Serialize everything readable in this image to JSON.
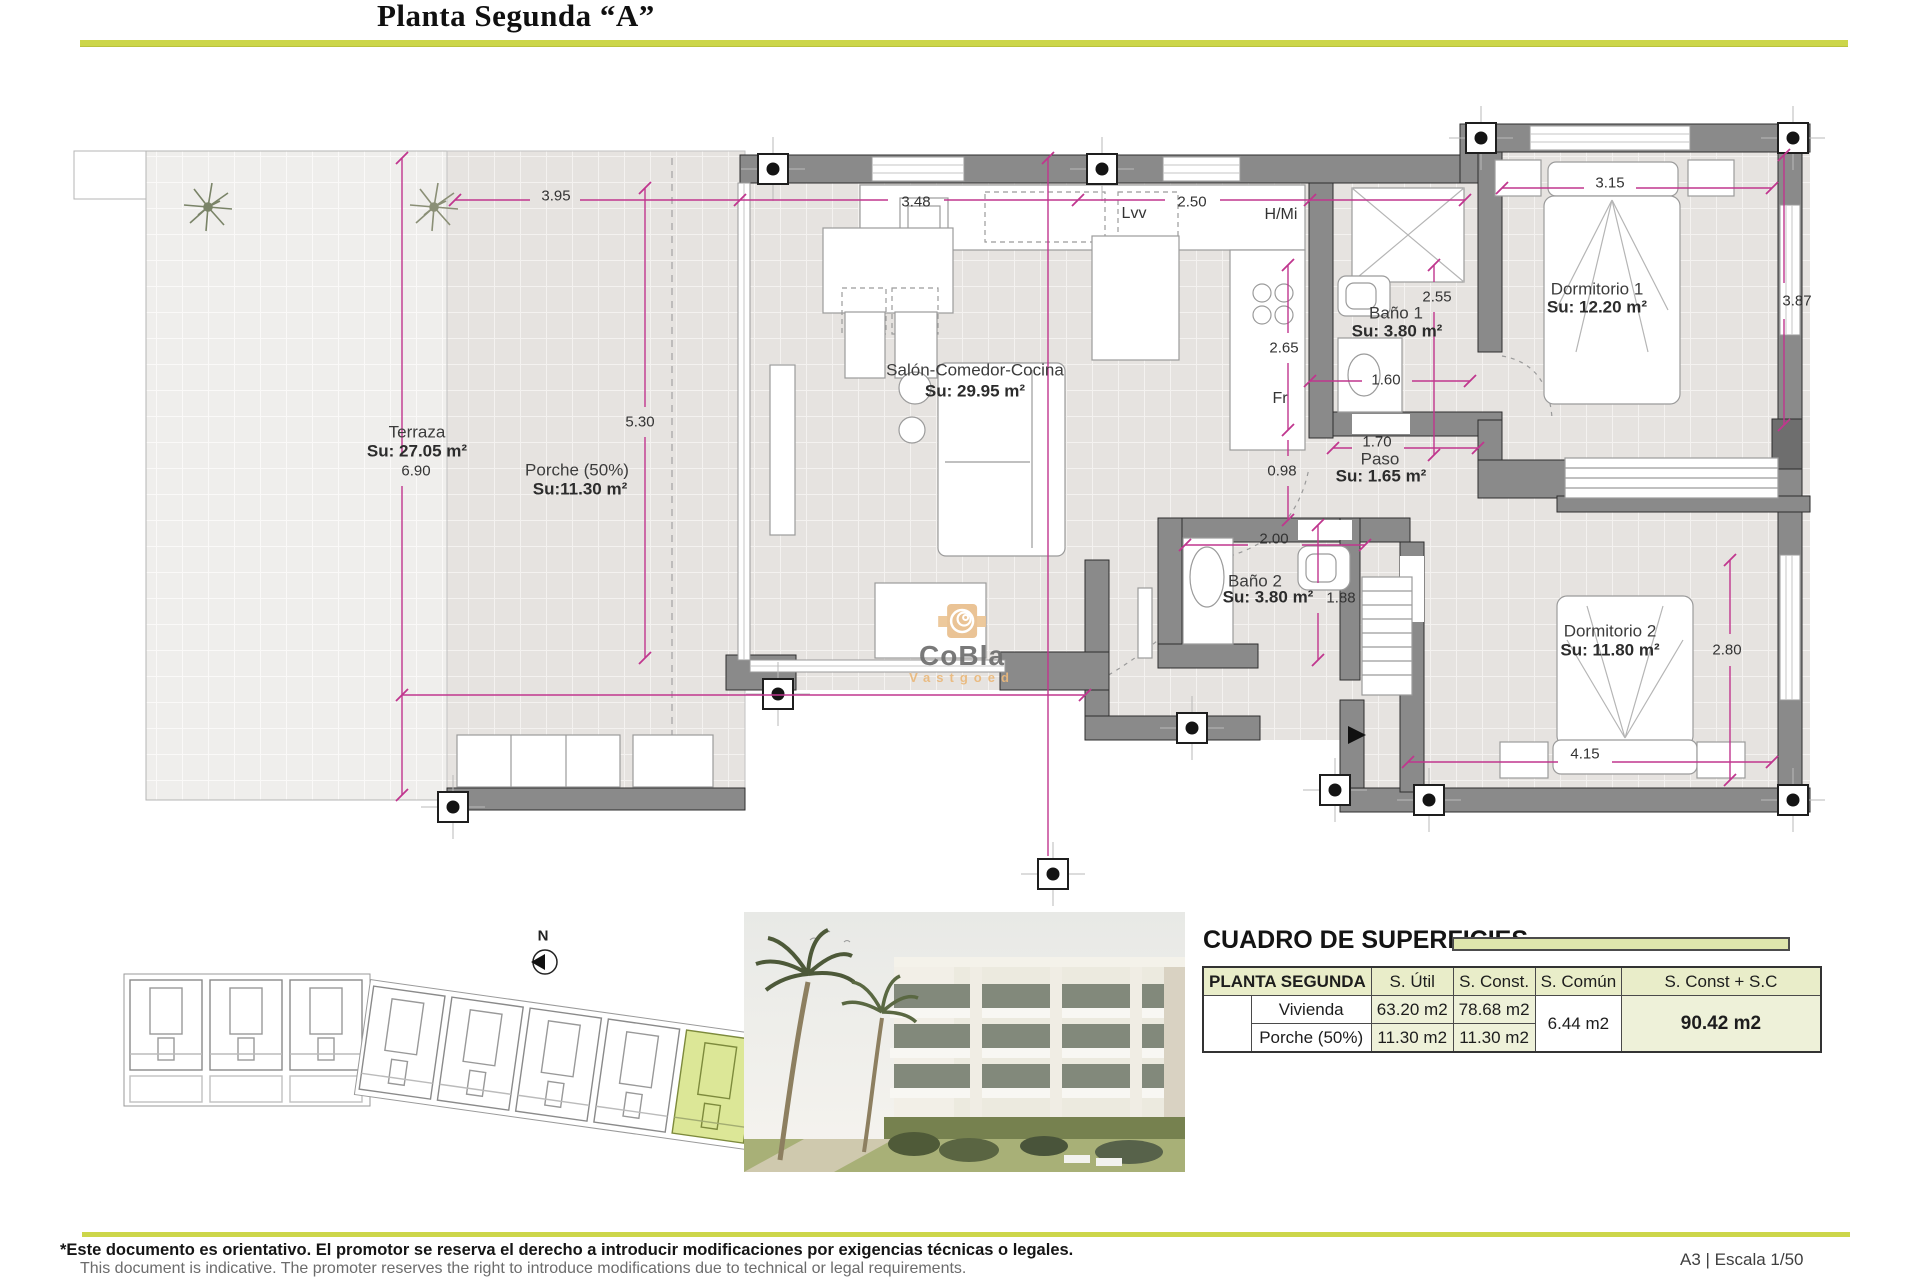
{
  "header": {
    "title": "Planta Segunda “A”"
  },
  "plan": {
    "rooms": [
      {
        "id": "terraza",
        "name": "Terraza",
        "area": "Su: 27.05 m²"
      },
      {
        "id": "porche",
        "name": "Porche (50%)",
        "area": "Su:11.30 m²"
      },
      {
        "id": "salon",
        "name": "Salón-Comedor-Cocina",
        "area": "Su: 29.95 m²"
      },
      {
        "id": "bano1",
        "name": "Baño 1",
        "area": "Su: 3.80 m²"
      },
      {
        "id": "paso",
        "name": "Paso",
        "area": "Su: 1.65 m²"
      },
      {
        "id": "bano2",
        "name": "Baño 2",
        "area": "Su: 3.80 m²"
      },
      {
        "id": "dorm1",
        "name": "Dormitorio 1",
        "area": "Su: 12.20 m²"
      },
      {
        "id": "dorm2",
        "name": "Dormitorio 2",
        "area": "Su: 11.80 m²"
      }
    ],
    "dims": {
      "d395": "3.95",
      "d348": "3.48",
      "d250": "2.50",
      "d255": "2.55",
      "d265": "2.65",
      "d160": "1.60",
      "d170": "1.70",
      "d098": "0.98",
      "d200": "2.00",
      "d188": "1.88",
      "d315": "3.15",
      "d387": "3.87",
      "d280": "2.80",
      "d415": "4.15",
      "d530": "5.30",
      "d690": "6.90"
    },
    "appliances": {
      "lvv": "Lvv",
      "hmi": "H/Mi",
      "fr": "Fr"
    },
    "compass": {
      "n": "N"
    }
  },
  "watermark": {
    "brand": "CoBla",
    "sub": "Vastgoed"
  },
  "table": {
    "heading": "CUADRO DE SUPERFICIES",
    "columns": {
      "planta": "PLANTA SEGUNDA",
      "util": "S. Útil",
      "construida": "S. Const.",
      "comun": "S. Común",
      "total": "S. Const + S.C"
    },
    "rows": [
      {
        "label": "Vivienda",
        "util": "63.20 m2",
        "construida": "78.68 m2"
      },
      {
        "label": "Porche (50%)",
        "util": "11.30 m2",
        "construida": "11.30 m2"
      }
    ],
    "comun": "6.44 m2",
    "total": "90.42 m2"
  },
  "footer": {
    "disclaimer_es": "*Este documento es orientativo. El promotor se reserva el derecho a introducir modificaciones por exigencias técnicas o legales.",
    "disclaimer_en": "This document is indicative. The promoter reserves the right to introduce modifications due to technical or legal requirements.",
    "scale": "A3 | Escala 1/50"
  }
}
